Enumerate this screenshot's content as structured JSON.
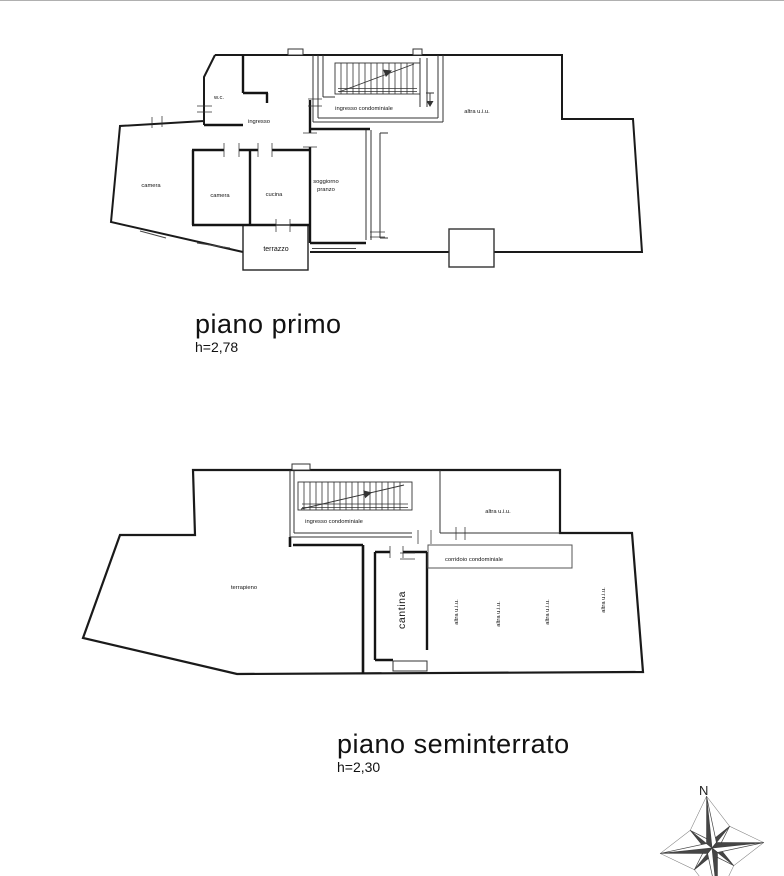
{
  "colors": {
    "line": "#1a1a1a",
    "label": "#111111",
    "top_border": "#b0b0b0"
  },
  "floor_plans": {
    "primo": {
      "title": "piano primo",
      "height": "h=2,78",
      "rooms": {
        "wc": "w.c.",
        "ingresso": "ingresso",
        "ingresso_condominiale": "ingresso condominiale",
        "altra_uiu": "altra u.i.u.",
        "camera_1": "camera",
        "camera_2": "camera",
        "cucina": "cucina",
        "soggiorno_line_1": "soggiorno",
        "soggiorno_line_2": "pranzo",
        "terrazzo": "terrazzo"
      }
    },
    "seminterrato": {
      "title": "piano seminterrato",
      "height": "h=2,30",
      "rooms": {
        "ingresso_condominiale": "ingresso condominiale",
        "altra_uiu_room": "altra u.i.u.",
        "corridoio_condominiale": "corridoio condominiale",
        "terrapieno": "terrapieno",
        "cantina": "cantina",
        "cells": [
          "altra u.i.u.",
          "altra u.i.u.",
          "altra u.i.u.",
          "altra u.i.u."
        ]
      }
    }
  },
  "compass": {
    "north": "N"
  }
}
